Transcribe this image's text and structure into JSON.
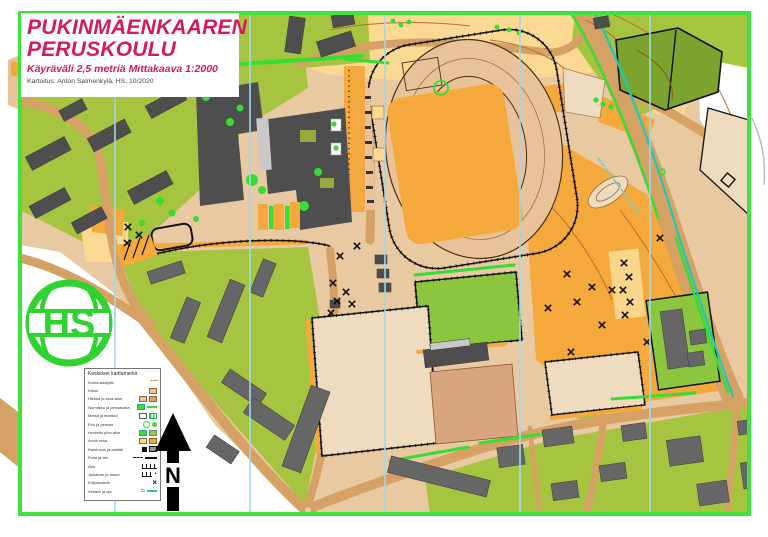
{
  "title_block": {
    "line1": "PUKINMÄENKAAREN",
    "line2": "PERUSKOULU",
    "subtitle": "Käyräväli 2,5 metriä  Mittakaava 1:2000",
    "credit": "Kartoitus: Anton Salmenkylä, HS, 10/2020"
  },
  "map_info": {
    "scale": "1:2000",
    "contour_interval": "2,5 m"
  },
  "logo": {
    "text": "HS"
  },
  "compass": {
    "label": "N"
  },
  "legend": {
    "title": "Keskeiset karttamerkit",
    "items": [
      {
        "label": "Korkeuskäyrät",
        "symbol": "contour"
      },
      {
        "label": "Katos",
        "symbol": "canopy"
      },
      {
        "label": "Hiekka ja sora-alue",
        "symbol": "sandpair"
      },
      {
        "label": "Nurmikko ja pensasaita",
        "symbol": "lawn"
      },
      {
        "label": "Metsä ja tiheikkö",
        "symbol": "forest"
      },
      {
        "label": "Puu ja pensas",
        "symbol": "tree"
      },
      {
        "label": "Hoidettu piha-alue",
        "symbol": "yard"
      },
      {
        "label": "Avoin maa",
        "symbol": "open"
      },
      {
        "label": "Rakennus ja asfaltti",
        "symbol": "paved"
      },
      {
        "label": "Polut ja tiet",
        "symbol": "paths"
      },
      {
        "label": "Aita",
        "symbol": "fence"
      },
      {
        "label": "Jyrkänne ja muuri",
        "symbol": "cliff"
      },
      {
        "label": "Erityiskohde",
        "symbol": "xmark"
      },
      {
        "label": "Vesistö ja oja",
        "symbol": "water"
      }
    ]
  },
  "palette": {
    "magenta": "#D6185E",
    "frame": "#3CE43C",
    "olive": "#A6C440",
    "pitch": "#8CC63F",
    "forest": "#7BA32D",
    "brightgreen": "#35DD35",
    "orange": "#F5A93C",
    "paleyellow": "#FBD992",
    "tanplaza": "#E9C9A2",
    "track": "#E9C29A",
    "road": "#D6A164",
    "sand": "#EFDCC0",
    "clay": "#D8A57E",
    "school": "#4E4E4E",
    "house": "#666666",
    "lightgray": "#C9C9C9",
    "cyan": "#9FD9E9",
    "stream": "#1EC8B4",
    "contour": "#B5722E",
    "logogreen": "#2FD32F"
  }
}
